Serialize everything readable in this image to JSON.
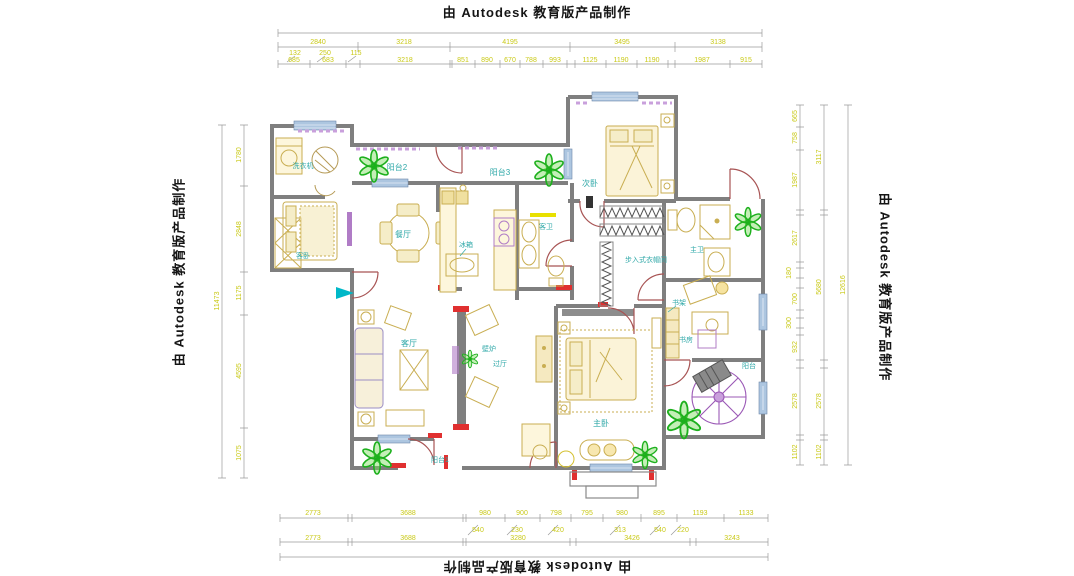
{
  "watermark": {
    "text": "由 Autodesk 教育版产品制作"
  },
  "rooms": {
    "laundry": "洗衣机",
    "balcony2": "阳台2",
    "guest_bedroom": "客卧",
    "dining": "餐厅",
    "balcony3": "阳台3",
    "fridge": "冰箱",
    "secondary_bedroom": "次卧",
    "guest_bath": "客卫",
    "master_bath": "主卫",
    "walkin_closet": "步入式衣帽间",
    "bookshelf": "书架",
    "study": "书房",
    "balcony_right": "阳台",
    "living": "客厅",
    "fireplace": "壁炉",
    "hallway": "过厅",
    "master_bedroom": "主卧",
    "balcony1": "阳台1"
  },
  "dims": {
    "top_major": [
      "2840",
      "3218",
      "4195",
      "3495",
      "3138"
    ],
    "top_minor": [
      "685",
      "683",
      "3218",
      "851",
      "890",
      "670",
      "788",
      "993",
      "1125",
      "1190",
      "1190",
      "1987",
      "915"
    ],
    "top_offsets": [
      "132",
      "250",
      "115"
    ],
    "bottom_minor": [
      "2773",
      "3688",
      "980",
      "900",
      "798",
      "795",
      "980",
      "895",
      "1193",
      "1133"
    ],
    "bottom_offsets": [
      "540",
      "230",
      "420",
      "313",
      "540",
      "220"
    ],
    "bottom_major": [
      "2773",
      "3688",
      "3280",
      "3426",
      "3243"
    ],
    "left_segments": [
      "1780",
      "2848",
      "1175",
      "4595",
      "1075"
    ],
    "left_total": "11473",
    "right_inner": [
      "665",
      "758",
      "1987",
      "2617",
      "180",
      "700",
      "300",
      "932",
      "2578",
      "1102"
    ],
    "right_middle": [
      "3117",
      "5680",
      "2578",
      "1102"
    ],
    "right_total": "12616"
  },
  "colors": {
    "wall": "#7f7f7f",
    "dimension_text": "#c9c917",
    "room_label": "#2fa8a8",
    "door_arc": "#a85454",
    "window": "#adc6e0",
    "accent_red": "#e03030",
    "plant_green": "#1db01d",
    "furniture_tan": "#c9ae52",
    "fixture_purple": "#b07cc6"
  }
}
